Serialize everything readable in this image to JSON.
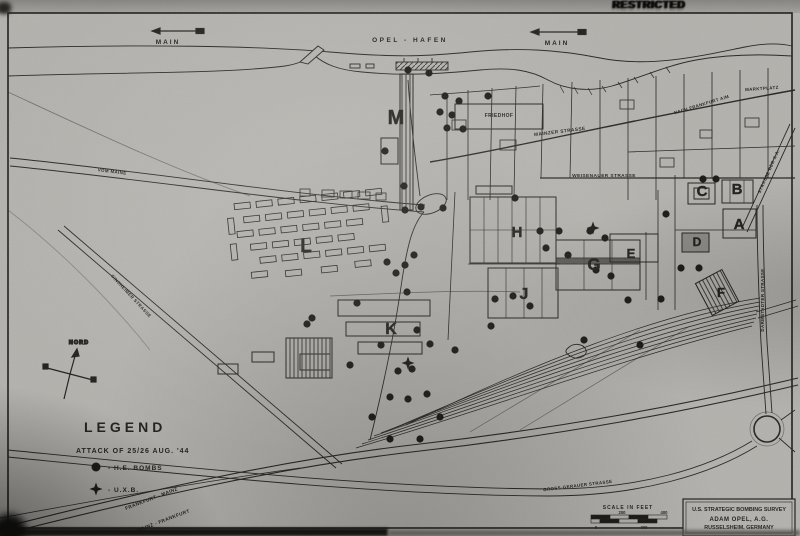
{
  "stamp": {
    "text": "RESTRICTED"
  },
  "map": {
    "colors": {
      "paper": "#b3b1ac",
      "ink": "#1d1d1b"
    },
    "labels": [
      {
        "id": "main-river-west",
        "t": "MAIN",
        "x": 168,
        "y": 44,
        "s": 6.5,
        "sp": 2
      },
      {
        "id": "main-river-east",
        "t": "MAIN",
        "x": 557,
        "y": 45,
        "s": 6.5,
        "sp": 2
      },
      {
        "id": "opel-hafen",
        "t": "OPEL - HAFEN",
        "x": 410,
        "y": 42,
        "s": 6.5,
        "sp": 2.5
      },
      {
        "id": "friedhof",
        "t": "FRIEDHOF",
        "x": 499,
        "y": 117,
        "s": 5
      },
      {
        "id": "mainzer-strasse",
        "t": "MAINZER STRASSE",
        "x": 560,
        "y": 133,
        "s": 4.8,
        "r": -7
      },
      {
        "id": "nach-frankfurt",
        "t": "NACH FRANKFURT A/M",
        "x": 702,
        "y": 106,
        "s": 4.4,
        "r": -17
      },
      {
        "id": "marktplatz",
        "t": "MARKTPLATZ",
        "x": 762,
        "y": 90,
        "s": 4.4,
        "r": -4
      },
      {
        "id": "weisenauer-strasse",
        "t": "WEISENAUER STRASSE",
        "x": 604,
        "y": 177,
        "s": 4.8
      },
      {
        "id": "strasse-der-sa",
        "t": "STRASSE DER S.A.",
        "x": 770,
        "y": 172,
        "s": 4.4,
        "r": -66
      },
      {
        "id": "darmstaedter-strasse",
        "t": "DARMSTADTER STRASSE",
        "x": 764,
        "y": 300,
        "s": 4.4,
        "r": -90
      },
      {
        "id": "vom-maine",
        "t": "VOM MAINE",
        "x": 112,
        "y": 173,
        "s": 4.4,
        "r": 7
      },
      {
        "id": "ginsheimer-strasse",
        "t": "GINSHEIMER STRASSE",
        "x": 130,
        "y": 297,
        "s": 4.4,
        "r": 47
      },
      {
        "id": "gross-gerauer-strasse",
        "t": "GROSS-GERAUER STRASSE",
        "x": 578,
        "y": 487,
        "s": 4.4,
        "r": -7
      },
      {
        "id": "rail-frankfurt-mainz",
        "t": "FRANKFURT - MAINZ",
        "x": 152,
        "y": 500,
        "s": 4.8,
        "r": -21
      },
      {
        "id": "rail-mainz-frankfurt",
        "t": "MAINZ - FRANKFURT",
        "x": 164,
        "y": 522,
        "s": 4.8,
        "r": -21
      }
    ],
    "building_letters": [
      {
        "t": "A",
        "x": 739,
        "y": 229,
        "s": 15
      },
      {
        "t": "B",
        "x": 737,
        "y": 194,
        "s": 15
      },
      {
        "t": "C",
        "x": 702,
        "y": 196,
        "s": 15
      },
      {
        "t": "D",
        "x": 697,
        "y": 246,
        "s": 12
      },
      {
        "t": "E",
        "x": 631,
        "y": 258,
        "s": 13
      },
      {
        "t": "F",
        "x": 721,
        "y": 297,
        "s": 13
      },
      {
        "t": "G",
        "x": 594,
        "y": 270,
        "s": 17
      },
      {
        "t": "H",
        "x": 517,
        "y": 237,
        "s": 15
      },
      {
        "t": "J",
        "x": 524,
        "y": 299,
        "s": 16
      },
      {
        "t": "K",
        "x": 391,
        "y": 334,
        "s": 16
      },
      {
        "t": "L",
        "x": 306,
        "y": 252,
        "s": 19
      },
      {
        "t": "M",
        "x": 396,
        "y": 124,
        "s": 20
      }
    ],
    "bombs": [
      [
        408,
        70
      ],
      [
        429,
        73
      ],
      [
        445,
        96
      ],
      [
        459,
        101
      ],
      [
        488,
        96
      ],
      [
        440,
        112
      ],
      [
        452,
        115
      ],
      [
        447,
        128
      ],
      [
        463,
        129
      ],
      [
        385,
        151
      ],
      [
        404,
        186
      ],
      [
        421,
        207
      ],
      [
        443,
        208
      ],
      [
        405,
        210
      ],
      [
        515,
        198
      ],
      [
        540,
        231
      ],
      [
        559,
        231
      ],
      [
        546,
        248
      ],
      [
        568,
        255
      ],
      [
        590,
        231
      ],
      [
        605,
        238
      ],
      [
        596,
        270
      ],
      [
        611,
        276
      ],
      [
        628,
        300
      ],
      [
        495,
        299
      ],
      [
        513,
        296
      ],
      [
        530,
        306
      ],
      [
        491,
        326
      ],
      [
        703,
        179
      ],
      [
        716,
        179
      ],
      [
        666,
        214
      ],
      [
        681,
        268
      ],
      [
        699,
        268
      ],
      [
        661,
        299
      ],
      [
        414,
        255
      ],
      [
        405,
        265
      ],
      [
        387,
        262
      ],
      [
        396,
        273
      ],
      [
        407,
        292
      ],
      [
        357,
        303
      ],
      [
        312,
        318
      ],
      [
        307,
        324
      ],
      [
        417,
        330
      ],
      [
        430,
        344
      ],
      [
        381,
        345
      ],
      [
        350,
        365
      ],
      [
        398,
        371
      ],
      [
        412,
        369
      ],
      [
        390,
        397
      ],
      [
        408,
        399
      ],
      [
        427,
        394
      ],
      [
        440,
        417
      ],
      [
        372,
        417
      ],
      [
        390,
        439
      ],
      [
        420,
        439
      ],
      [
        455,
        350
      ],
      [
        584,
        340
      ],
      [
        640,
        345
      ]
    ],
    "uxb": [
      [
        593,
        228
      ],
      [
        408,
        363
      ]
    ],
    "compass": {
      "label": "NORD"
    },
    "legend": {
      "title": "LEGEND",
      "attack_line": "ATTACK OF 25/26 AUG. '44",
      "items": [
        {
          "symbol": "he-bomb",
          "label": "- H.E. BOMBS"
        },
        {
          "symbol": "uxb",
          "label": "- U.X.B."
        }
      ]
    },
    "scale_bar": {
      "title": "SCALE IN FEET",
      "ticks_top": [
        "200",
        "400"
      ],
      "ticks_bottom": [
        "0",
        "300"
      ]
    },
    "title_block": {
      "line1": "U.S. STRATEGIC BOMBING SURVEY",
      "line2": "ADAM OPEL, A.G.",
      "line3": "RUSSELSHEIM, GERMANY"
    }
  }
}
